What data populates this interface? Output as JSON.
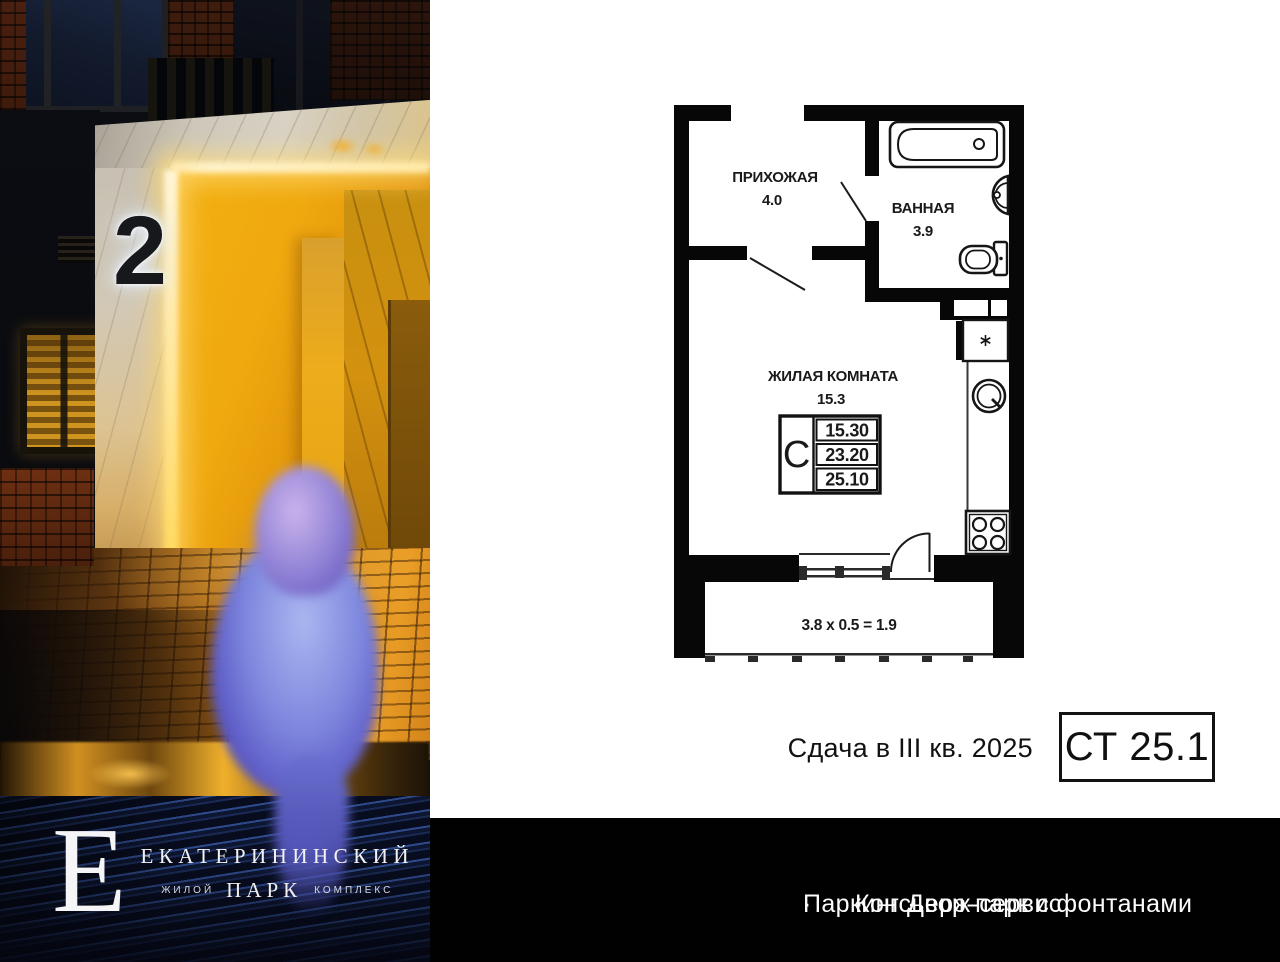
{
  "photo": {
    "building_number": "2"
  },
  "brand": {
    "monogram": "Е",
    "name": "ЕКАТЕРИНИНСКИЙ",
    "sub_left": "ЖИЛОЙ",
    "sub_center": "ПАРК",
    "sub_right": "КОМПЛЕКС"
  },
  "floor_plan": {
    "rooms": [
      {
        "name": "ПРИХОЖАЯ",
        "area": "4.0"
      },
      {
        "name": "ВАННАЯ",
        "area": "3.9"
      },
      {
        "name": "ЖИЛАЯ КОМНАТА",
        "area": "15.3"
      }
    ],
    "spec_table": {
      "type_letter": "С",
      "living_area": "15.30",
      "apartment_area": "23.20",
      "total_area": "25.10"
    },
    "balcony_formula": "3.8 x 0.5 = 1.9"
  },
  "listing": {
    "delivery": "Сдача в III кв. 2025",
    "unit_label": "СТ 25.1"
  },
  "amenities": {
    "bullet": "·",
    "items": [
      "Паркинг",
      "Консьерж-сервис",
      "Двор-парк с фонтанами"
    ]
  },
  "colors": {
    "bar_bg": "#010101",
    "plan_line": "#070707",
    "portal_warm": "#f0a90f",
    "bird_blue": "#7d86dd",
    "text": "#121212"
  }
}
